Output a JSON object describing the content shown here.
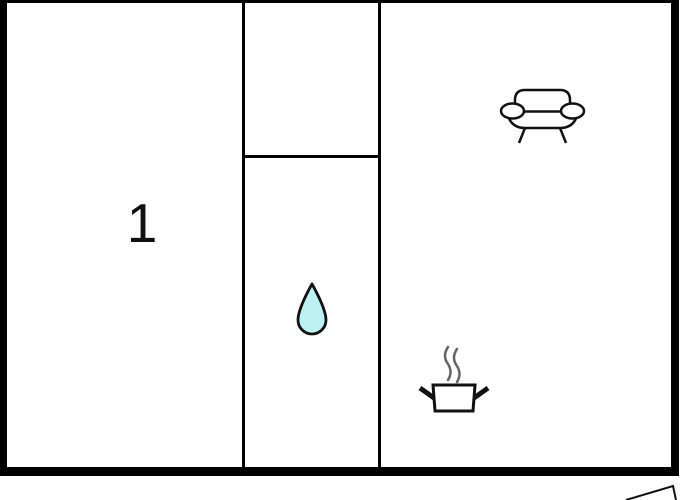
{
  "floorplan": {
    "room_label": "1",
    "colors": {
      "wall": "#000000",
      "background": "#ffffff",
      "outline": "#111111",
      "drop_fill": "#bdf2f2",
      "steam": "#666666"
    },
    "icons": [
      "sofa-icon",
      "water-drop-icon",
      "cooking-pot-icon",
      "steam-icon",
      "north-arrow-icon"
    ]
  }
}
